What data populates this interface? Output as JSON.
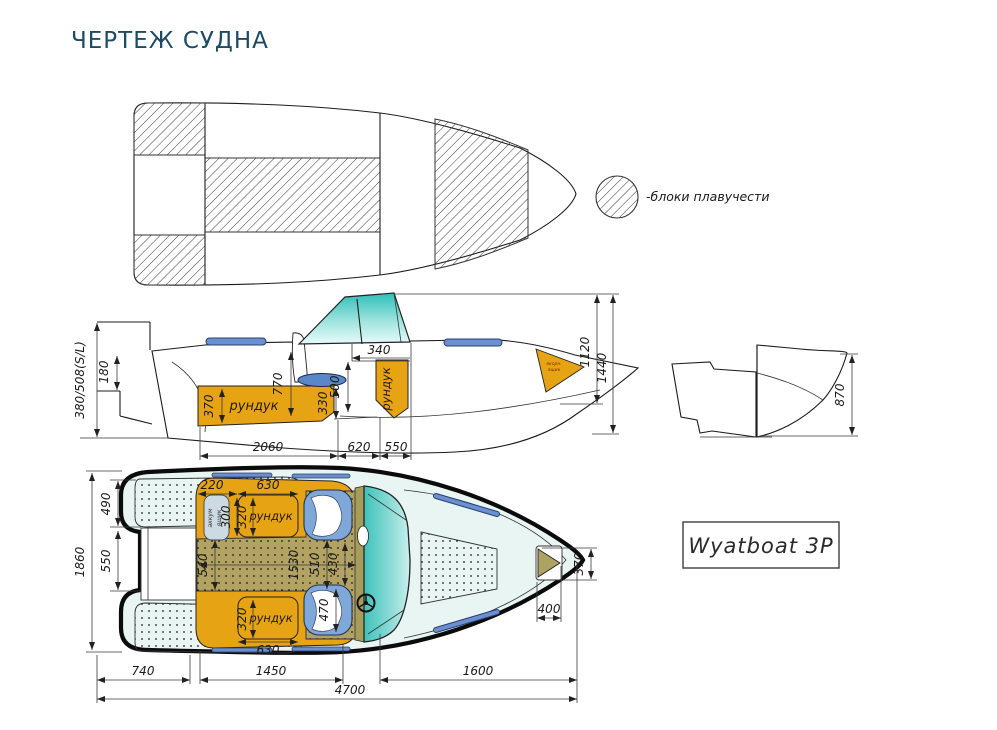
{
  "page": {
    "title": "ЧЕРТЕЖ СУДНА"
  },
  "legend": {
    "label": "-блоки плавучести"
  },
  "badge": {
    "model": "Wyatboat 3P"
  },
  "side": {
    "locker_stern": "рундук",
    "locker_bow": "рундук",
    "anchor_line1": "якорн.",
    "anchor_line2": "ящик",
    "d_transom": "380/508(S/L)",
    "d180": "180",
    "d370": "370",
    "d770": "770",
    "d330": "330",
    "d500": "500",
    "d340": "340",
    "d1120": "1120",
    "d1440": "1440",
    "d2060": "2060",
    "d620": "620",
    "d550": "550"
  },
  "transom": {
    "d870": "870"
  },
  "plan": {
    "locker_top": "рундук",
    "locker_bottom": "рундук",
    "battery_line1": "аккум",
    "battery_line2": "ящик",
    "d1860": "1860",
    "d490": "490",
    "d550": "550",
    "d220": "220",
    "d630_top": "630",
    "d300": "300",
    "d320_top": "320",
    "d540": "540",
    "d1530": "1530",
    "d510": "510",
    "d430": "430",
    "d470": "470",
    "d320_bottom": "320",
    "d630_bottom": "630",
    "d370": "370",
    "d400": "400",
    "d740": "740",
    "d1450": "1450",
    "d1600": "1600",
    "d4700": "4700"
  }
}
